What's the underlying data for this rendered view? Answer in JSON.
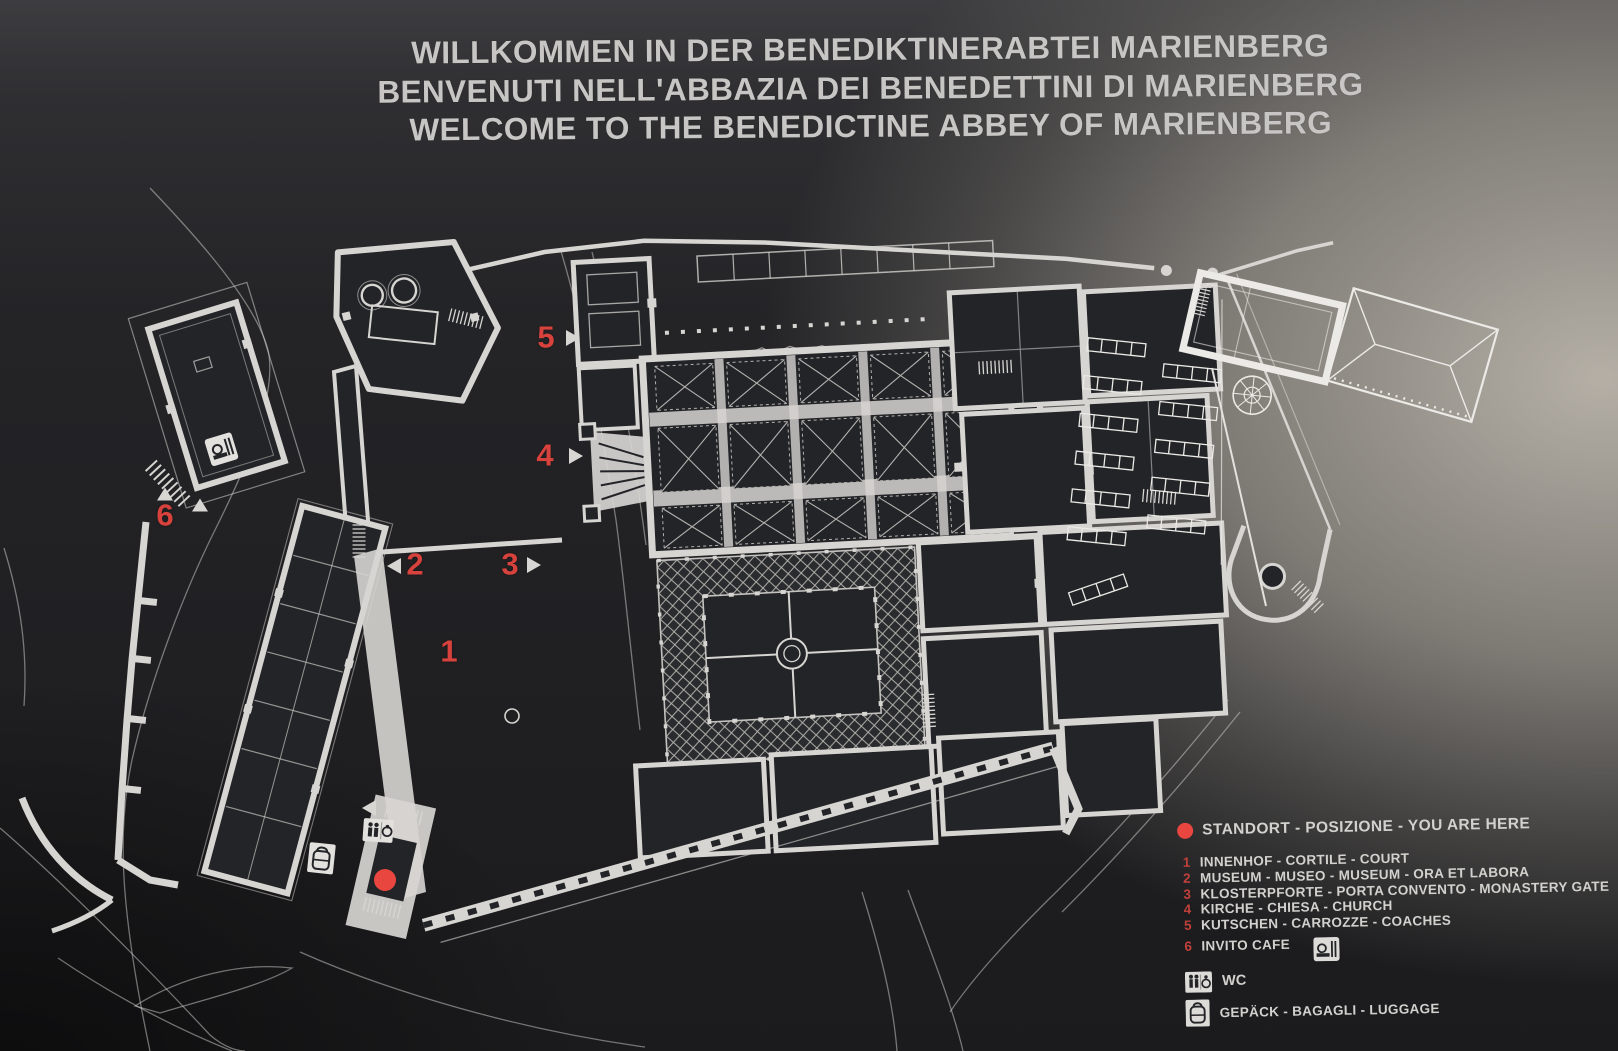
{
  "title": {
    "line1": "WILLKOMMEN IN DER BENEDIKTINERABTEI MARIENBERG",
    "line2": "BENVENUTI NELL'ABBAZIA DEI BENEDETTINI DI MARIENBERG",
    "line3": "WELCOME TO THE BENEDICTINE ABBEY OF MARIENBERG"
  },
  "legend": {
    "you_are_here_label": "STANDORT - POSIZIONE - YOU ARE HERE",
    "items": [
      {
        "num": "1",
        "label": "INNENHOF - CORTILE - COURT"
      },
      {
        "num": "2",
        "label": "MUSEUM - MUSEO - MUSEUM - ORA ET LABORA"
      },
      {
        "num": "3",
        "label": "KLOSTERPFORTE - PORTA CONVENTO - MONASTERY GATE"
      },
      {
        "num": "4",
        "label": "KIRCHE - CHIESA - CHURCH"
      },
      {
        "num": "5",
        "label": "KUTSCHEN - CARROZZE - COACHES"
      },
      {
        "num": "6",
        "label": "INVITO CAFE"
      }
    ],
    "wc_label": "WC",
    "luggage_label": "GEPÄCK - BAGAGLI - LUGGAGE"
  },
  "map_markers": {
    "m1": "1",
    "m2": "2",
    "m3": "3",
    "m4": "4",
    "m5": "5",
    "m6": "6"
  },
  "icons": {
    "you_are_here": "red-dot",
    "cafe": "cafe-icon",
    "wc": "wc-icon",
    "luggage": "backpack-icon"
  },
  "colors": {
    "marker_red": "#d8423c",
    "dot_red": "#e8463f",
    "plan_line": "#d7d5d1",
    "board_dark": "#232428"
  }
}
